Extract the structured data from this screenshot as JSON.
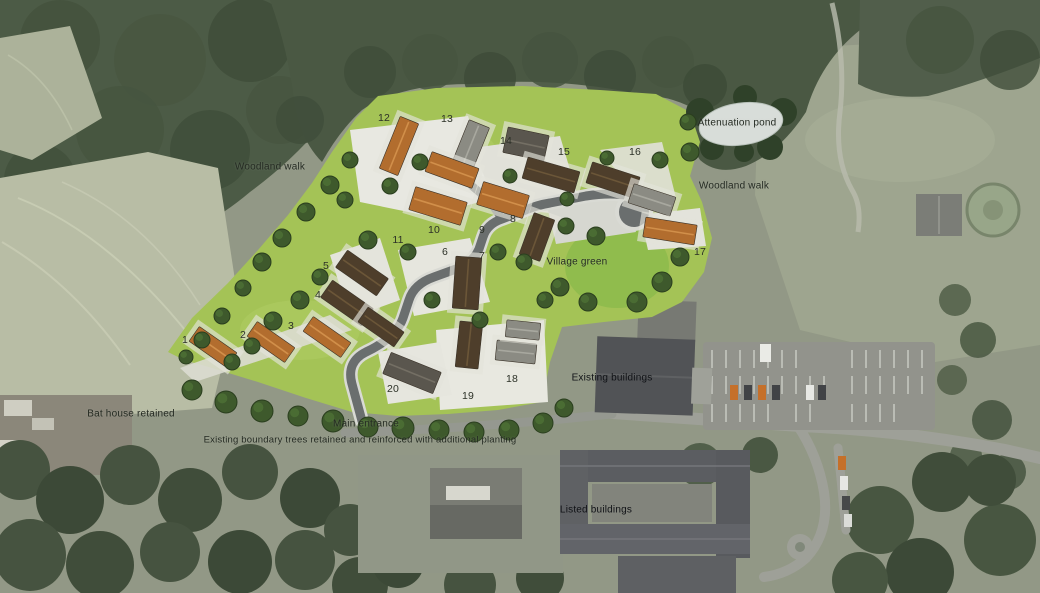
{
  "colors": {
    "lawn": "#a4c356",
    "village_green": "#90bc4d",
    "woodland": "#3e4c37",
    "field_pale": "#b6baa1",
    "pond": "#d8ddd9",
    "road_site": "#6a6e6e",
    "road_rural": "#9a9b93",
    "roof_orange": "#b26d2e",
    "roof_brown": "#4e3e2b",
    "roof_grey": "#8b8b83",
    "roof_darkgrey": "#5a564e",
    "building_dark": "#4b4c50"
  },
  "labels": [
    {
      "id": "attenuation-pond-label",
      "text": "Attenuation pond",
      "x": 737,
      "y": 123,
      "cls": ""
    },
    {
      "id": "woodland-walk-west-label",
      "text": "Woodland walk",
      "x": 270,
      "y": 167,
      "cls": ""
    },
    {
      "id": "woodland-walk-east-label",
      "text": "Woodland walk",
      "x": 734,
      "y": 186,
      "cls": ""
    },
    {
      "id": "village-green-label",
      "text": "Village green",
      "x": 577,
      "y": 262,
      "cls": ""
    },
    {
      "id": "existing-buildings-label",
      "text": "Existing buildings",
      "x": 612,
      "y": 378,
      "cls": "on-dark"
    },
    {
      "id": "bat-house-label",
      "text": "Bat house retained",
      "x": 131,
      "y": 414,
      "cls": ""
    },
    {
      "id": "main-entrance-label",
      "text": "Main entrance",
      "x": 366,
      "y": 424,
      "cls": ""
    },
    {
      "id": "boundary-trees-label",
      "text": "Existing boundary trees retained and reinforced with additional planting",
      "x": 360,
      "y": 440,
      "cls": "small"
    },
    {
      "id": "listed-buildings-label",
      "text": "Listed buildings",
      "x": 596,
      "y": 510,
      "cls": "on-dark"
    }
  ],
  "plot_numbers": [
    {
      "n": "1",
      "x": 185,
      "y": 340
    },
    {
      "n": "2",
      "x": 243,
      "y": 335
    },
    {
      "n": "3",
      "x": 291,
      "y": 326
    },
    {
      "n": "4",
      "x": 318,
      "y": 295
    },
    {
      "n": "5",
      "x": 326,
      "y": 266
    },
    {
      "n": "6",
      "x": 445,
      "y": 252
    },
    {
      "n": "7",
      "x": 482,
      "y": 256
    },
    {
      "n": "8",
      "x": 513,
      "y": 219
    },
    {
      "n": "9",
      "x": 482,
      "y": 230
    },
    {
      "n": "10",
      "x": 434,
      "y": 230
    },
    {
      "n": "11",
      "x": 398,
      "y": 240
    },
    {
      "n": "12",
      "x": 384,
      "y": 118
    },
    {
      "n": "13",
      "x": 447,
      "y": 119
    },
    {
      "n": "14",
      "x": 506,
      "y": 141
    },
    {
      "n": "15",
      "x": 564,
      "y": 152
    },
    {
      "n": "16",
      "x": 635,
      "y": 152
    },
    {
      "n": "17",
      "x": 700,
      "y": 252
    },
    {
      "n": "18",
      "x": 512,
      "y": 379
    },
    {
      "n": "19",
      "x": 468,
      "y": 396
    },
    {
      "n": "20",
      "x": 393,
      "y": 389
    }
  ],
  "site": {
    "houses": [
      {
        "x": 399,
        "y": 146,
        "w": 20,
        "h": 56,
        "rot": 22,
        "roof": "orange"
      },
      {
        "x": 470,
        "y": 147,
        "w": 22,
        "h": 50,
        "rot": 22,
        "roof": "grey"
      },
      {
        "x": 452,
        "y": 170,
        "w": 50,
        "h": 21,
        "rot": 20,
        "roof": "orange"
      },
      {
        "x": 526,
        "y": 144,
        "w": 42,
        "h": 26,
        "rot": 12,
        "roof": "darkgrey"
      },
      {
        "x": 551,
        "y": 175,
        "w": 54,
        "h": 22,
        "rot": 16,
        "roof": "brown"
      },
      {
        "x": 613,
        "y": 180,
        "w": 50,
        "h": 22,
        "rot": 18,
        "roof": "brown"
      },
      {
        "x": 652,
        "y": 200,
        "w": 44,
        "h": 20,
        "rot": 18,
        "roof": "grey"
      },
      {
        "x": 670,
        "y": 231,
        "w": 52,
        "h": 20,
        "rot": 9,
        "roof": "orange"
      },
      {
        "x": 438,
        "y": 206,
        "w": 54,
        "h": 24,
        "rot": 17,
        "roof": "orange"
      },
      {
        "x": 503,
        "y": 200,
        "w": 48,
        "h": 24,
        "rot": 17,
        "roof": "orange"
      },
      {
        "x": 537,
        "y": 237,
        "w": 22,
        "h": 44,
        "rot": 20,
        "roof": "brown"
      },
      {
        "x": 362,
        "y": 273,
        "w": 50,
        "h": 21,
        "rot": 35,
        "roof": "brown"
      },
      {
        "x": 347,
        "y": 303,
        "w": 50,
        "h": 21,
        "rot": 35,
        "roof": "brown"
      },
      {
        "x": 213,
        "y": 347,
        "w": 46,
        "h": 18,
        "rot": 35,
        "roof": "orange"
      },
      {
        "x": 271,
        "y": 342,
        "w": 46,
        "h": 18,
        "rot": 35,
        "roof": "orange"
      },
      {
        "x": 327,
        "y": 337,
        "w": 46,
        "h": 18,
        "rot": 35,
        "roof": "orange"
      },
      {
        "x": 381,
        "y": 327,
        "w": 44,
        "h": 18,
        "rot": 35,
        "roof": "brown"
      },
      {
        "x": 467,
        "y": 283,
        "w": 26,
        "h": 52,
        "rot": 4,
        "roof": "brown"
      },
      {
        "x": 412,
        "y": 373,
        "w": 54,
        "h": 23,
        "rot": 22,
        "roof": "darkgrey"
      },
      {
        "x": 469,
        "y": 345,
        "w": 23,
        "h": 46,
        "rot": 6,
        "roof": "brown"
      },
      {
        "x": 516,
        "y": 352,
        "w": 40,
        "h": 20,
        "rot": 6,
        "roof": "grey"
      },
      {
        "x": 523,
        "y": 330,
        "w": 34,
        "h": 17,
        "rot": 6,
        "roof": "grey"
      }
    ],
    "trees": [
      [
        350,
        160,
        8
      ],
      [
        330,
        185,
        9
      ],
      [
        306,
        212,
        9
      ],
      [
        282,
        238,
        9
      ],
      [
        262,
        262,
        9
      ],
      [
        243,
        288,
        8
      ],
      [
        222,
        316,
        8
      ],
      [
        202,
        340,
        8
      ],
      [
        186,
        357,
        7
      ],
      [
        345,
        200,
        8
      ],
      [
        390,
        186,
        8
      ],
      [
        420,
        162,
        8
      ],
      [
        368,
        240,
        9
      ],
      [
        408,
        252,
        8
      ],
      [
        320,
        277,
        8
      ],
      [
        300,
        300,
        9
      ],
      [
        273,
        321,
        9
      ],
      [
        252,
        346,
        8
      ],
      [
        232,
        362,
        8
      ],
      [
        498,
        252,
        8
      ],
      [
        524,
        262,
        8
      ],
      [
        545,
        300,
        8
      ],
      [
        560,
        287,
        9
      ],
      [
        588,
        302,
        9
      ],
      [
        637,
        302,
        10
      ],
      [
        662,
        282,
        10
      ],
      [
        680,
        257,
        9
      ],
      [
        596,
        236,
        9
      ],
      [
        566,
        226,
        8
      ],
      [
        480,
        320,
        8
      ],
      [
        432,
        300,
        8
      ],
      [
        510,
        176,
        7
      ],
      [
        567,
        199,
        7
      ],
      [
        607,
        158,
        7
      ],
      [
        660,
        160,
        8
      ],
      [
        688,
        122,
        8
      ],
      [
        690,
        152,
        9
      ],
      [
        192,
        390,
        10
      ],
      [
        226,
        402,
        11
      ],
      [
        262,
        411,
        11
      ],
      [
        298,
        416,
        10
      ],
      [
        333,
        421,
        11
      ],
      [
        368,
        427,
        10
      ],
      [
        403,
        428,
        11
      ],
      [
        439,
        430,
        10
      ],
      [
        474,
        432,
        10
      ],
      [
        509,
        430,
        10
      ],
      [
        543,
        423,
        10
      ],
      [
        564,
        408,
        9
      ]
    ]
  }
}
